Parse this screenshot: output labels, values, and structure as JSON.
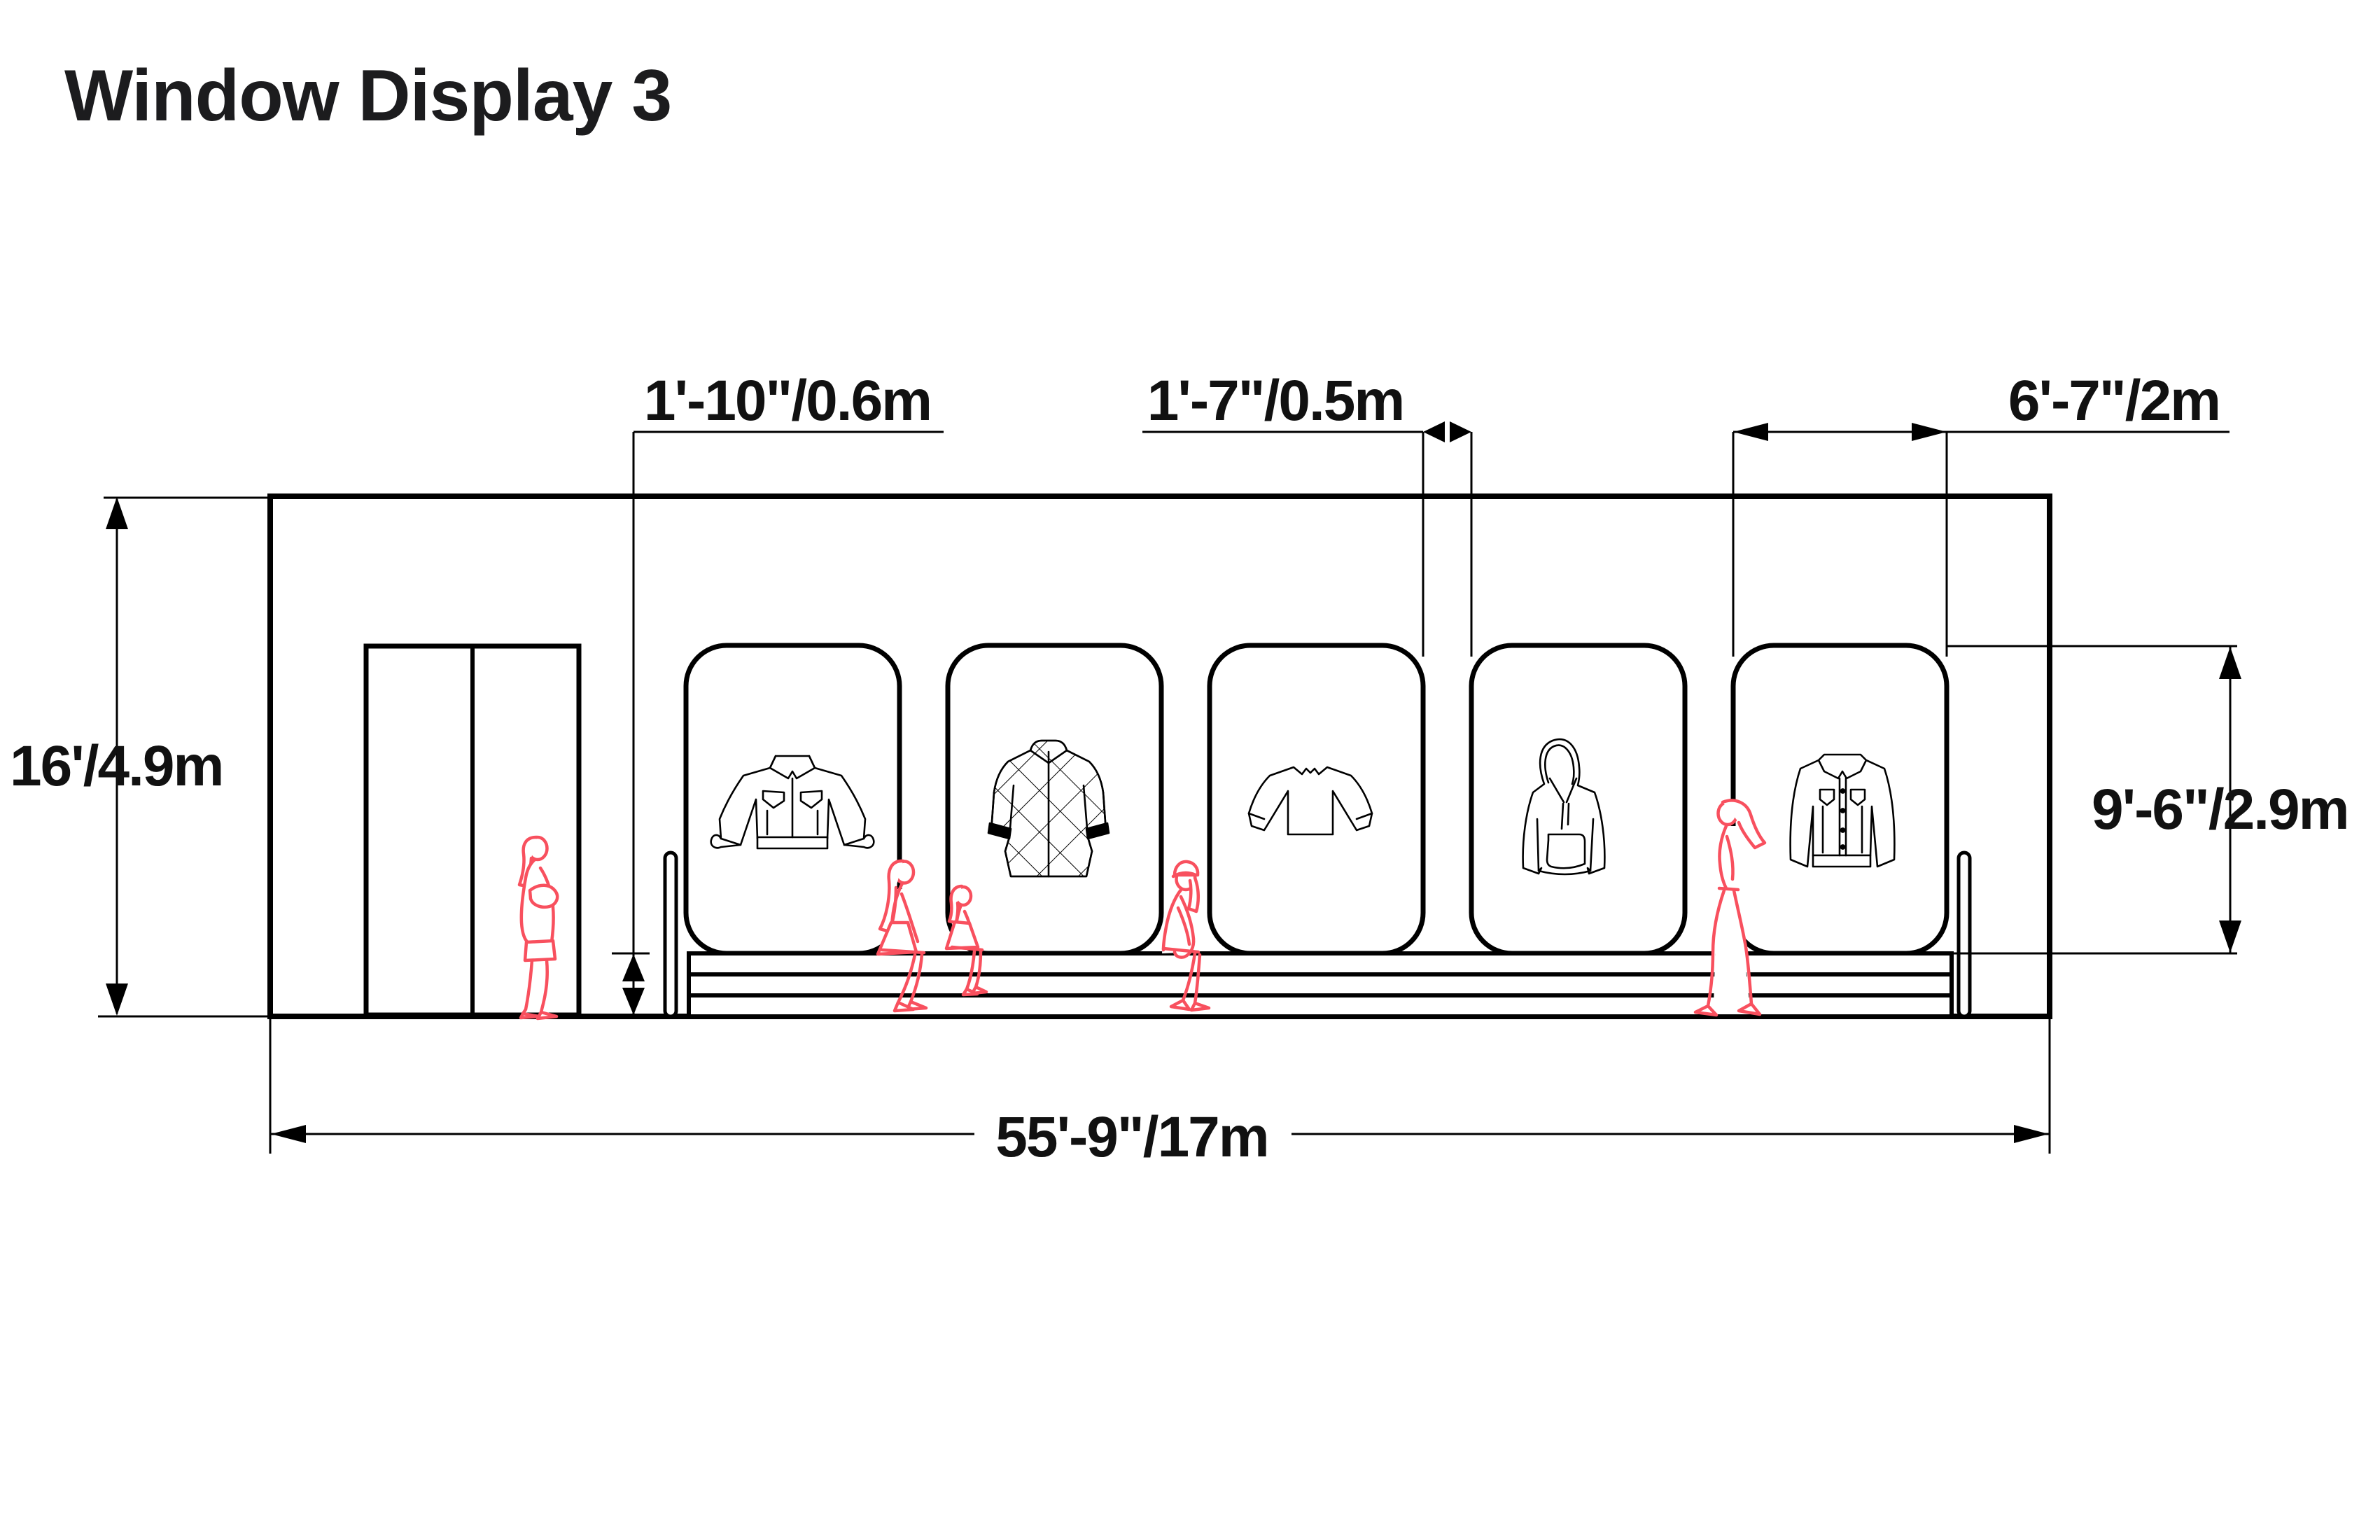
{
  "title": "Window Display 3",
  "drawing_type": "storefront elevation",
  "colors": {
    "line": "#000000",
    "figure_red": "#f8505e",
    "background": "#ffffff",
    "text": "#1c1c1e"
  },
  "dimensions": {
    "building_height": {
      "label": "16'/4.9m",
      "measures": "overall storefront height"
    },
    "bench_height": {
      "label": "1'-10\"/0.6m",
      "measures": "display plinth / bench height"
    },
    "window_gap": {
      "label": "1'-7\"/0.5m",
      "measures": "gap between display windows"
    },
    "window_width": {
      "label": "6'-7\"/2m",
      "measures": "display window width"
    },
    "window_height": {
      "label": "9'-6\"/2.9m",
      "measures": "display window height"
    },
    "building_width": {
      "label": "55'-9\"/17m",
      "measures": "overall storefront width"
    }
  },
  "elevation": {
    "door": "double-door",
    "windows": [
      {
        "id": 1,
        "garment": "jacket"
      },
      {
        "id": 2,
        "garment": "quilted-coat"
      },
      {
        "id": 3,
        "garment": "sweater"
      },
      {
        "id": 4,
        "garment": "hoodie"
      },
      {
        "id": 5,
        "garment": "denim-jacket"
      }
    ],
    "figures": [
      "standing-woman",
      "sitting-woman",
      "sitting-child",
      "sitting-woman-cap",
      "walking-woman"
    ]
  }
}
